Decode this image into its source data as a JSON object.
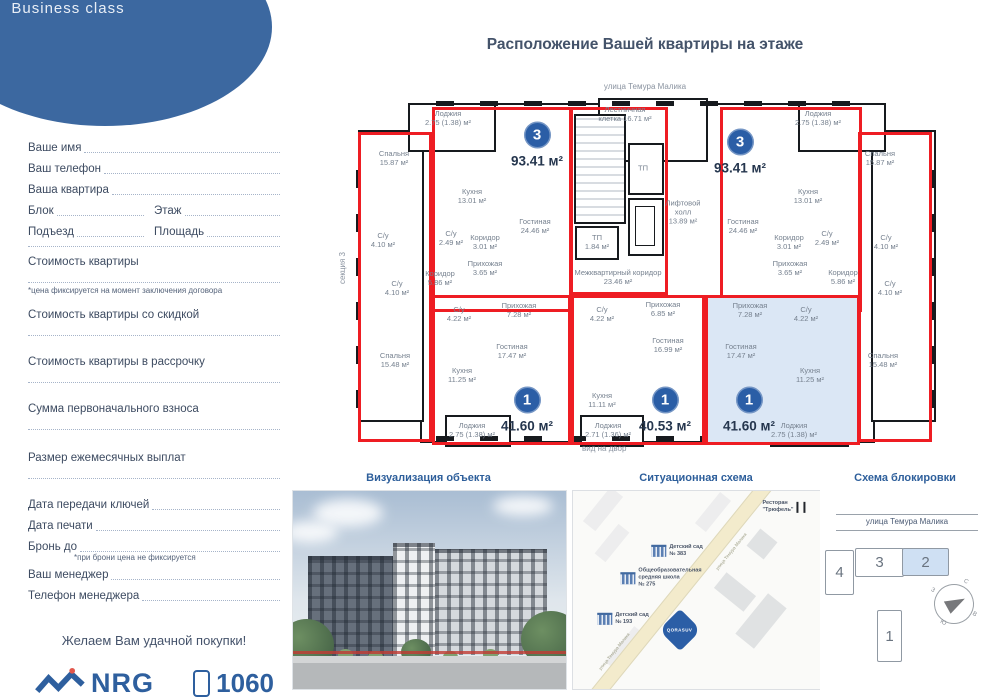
{
  "logo": {
    "brand": "QORASUV",
    "subtitle": "Business class"
  },
  "form": {
    "name_label": "Ваше имя",
    "phone_label": "Ваш телефон",
    "apartment_label": "Ваша квартира",
    "block_label": "Блок",
    "floor_label": "Этаж",
    "entrance_label": "Подъезд",
    "area_label": "Площадь",
    "price_label": "Стоимость квартиры",
    "price_note": "*цена фиксируется на момент заключения договора",
    "discount_price_label": "Стоимость квартиры со скидкой",
    "installment_price_label": "Стоимость квартиры в рассрочку",
    "down_payment_label": "Сумма первоначального взноса",
    "monthly_payment_label": "Размер ежемесячных выплат",
    "keys_date_label": "Дата передачи ключей",
    "print_date_label": "Дата печати",
    "reserve_until_label": "Бронь до",
    "reserve_note": "*при брони цена не фиксируется",
    "manager_label": "Ваш менеджер",
    "manager_phone_label": "Телефон менеджера",
    "wish": "Желаем Вам удачной покупки!"
  },
  "footer": {
    "brand": "NRG",
    "phone": "1060"
  },
  "floorplan": {
    "title": "Расположение Вашей квартиры на этаже",
    "street_top": "улица Темура Малика",
    "yard_label": "вид на двор",
    "section_label": "секция 3",
    "badges": [
      {
        "num": "3",
        "area": "93.41 м²",
        "x": 185,
        "y": 40
      },
      {
        "num": "3",
        "area": "93.41 м²",
        "x": 388,
        "y": 47
      },
      {
        "num": "1",
        "area": "41.60 м²",
        "x": 175,
        "y": 305
      },
      {
        "num": "1",
        "area": "40.53 м²",
        "x": 313,
        "y": 305
      },
      {
        "num": "1",
        "area": "41.60 м²",
        "x": 397,
        "y": 305
      }
    ],
    "rooms": [
      {
        "t": "Лоджия\n2.75 (1.38) м²",
        "x": 96,
        "y": 26
      },
      {
        "t": "Спальня\n15.87 м²",
        "x": 42,
        "y": 66
      },
      {
        "t": "Кухня\n13.01 м²",
        "x": 120,
        "y": 104
      },
      {
        "t": "Гостиная\n24.46 м²",
        "x": 183,
        "y": 134
      },
      {
        "t": "С/у\n2.49 м²",
        "x": 99,
        "y": 146
      },
      {
        "t": "Коридор\n3.01 м²",
        "x": 133,
        "y": 150
      },
      {
        "t": "Прихожая\n3.65 м²",
        "x": 133,
        "y": 176
      },
      {
        "t": "С/у\n4.10 м²",
        "x": 31,
        "y": 148
      },
      {
        "t": "С/у\n4.10 м²",
        "x": 45,
        "y": 196
      },
      {
        "t": "Коридор\n5.86 м²",
        "x": 88,
        "y": 186
      },
      {
        "t": "Спальня\n15.48 м²",
        "x": 43,
        "y": 268
      },
      {
        "t": "Лестничная\nклетка 16.71 м²",
        "x": 273,
        "y": 22
      },
      {
        "t": "ТП",
        "x": 291,
        "y": 76
      },
      {
        "t": "Лифтовой\nхолл\n13.89 м²",
        "x": 331,
        "y": 120
      },
      {
        "t": "ТП\n1.84 м²",
        "x": 245,
        "y": 150
      },
      {
        "t": "Межквартирный коридор\n23.46 м²",
        "x": 266,
        "y": 185
      },
      {
        "t": "Лоджия\n2.75 (1.38) м²",
        "x": 466,
        "y": 26
      },
      {
        "t": "Спальня\n15.87 м²",
        "x": 528,
        "y": 66
      },
      {
        "t": "Кухня\n13.01 м²",
        "x": 456,
        "y": 104
      },
      {
        "t": "Гостиная\n24.46 м²",
        "x": 391,
        "y": 134
      },
      {
        "t": "С/у\n2.49 м²",
        "x": 475,
        "y": 146
      },
      {
        "t": "Коридор\n3.01 м²",
        "x": 437,
        "y": 150
      },
      {
        "t": "Прихожая\n3.65 м²",
        "x": 438,
        "y": 176
      },
      {
        "t": "С/у\n4.10 м²",
        "x": 534,
        "y": 150
      },
      {
        "t": "С/у\n4.10 м²",
        "x": 538,
        "y": 196
      },
      {
        "t": "Коридор\n5.86 м²",
        "x": 491,
        "y": 185
      },
      {
        "t": "Спальня\n15.48 м²",
        "x": 531,
        "y": 268
      },
      {
        "t": "С/у\n4.22 м²",
        "x": 107,
        "y": 222
      },
      {
        "t": "Прихожая\n7.28 м²",
        "x": 167,
        "y": 218
      },
      {
        "t": "Гостиная\n17.47 м²",
        "x": 160,
        "y": 259
      },
      {
        "t": "Кухня\n11.25 м²",
        "x": 110,
        "y": 283
      },
      {
        "t": "Лоджия\n2.75 (1.38) м²",
        "x": 120,
        "y": 338
      },
      {
        "t": "С/у\n4.22 м²",
        "x": 250,
        "y": 222
      },
      {
        "t": "Прихожая\n6.85 м²",
        "x": 311,
        "y": 217
      },
      {
        "t": "Гостиная\n16.99 м²",
        "x": 316,
        "y": 253
      },
      {
        "t": "Кухня\n11.11 м²",
        "x": 250,
        "y": 308
      },
      {
        "t": "Лоджия\n2.71 (1.36) м²",
        "x": 256,
        "y": 338
      },
      {
        "t": "Прихожая\n7.28 м²",
        "x": 398,
        "y": 218
      },
      {
        "t": "С/у\n4.22 м²",
        "x": 454,
        "y": 222
      },
      {
        "t": "Гостиная\n17.47 м²",
        "x": 389,
        "y": 259
      },
      {
        "t": "Кухня\n11.25 м²",
        "x": 458,
        "y": 283
      },
      {
        "t": "Лоджия\n2.75 (1.38) м²",
        "x": 442,
        "y": 338
      }
    ]
  },
  "viz": {
    "title": "Визуализация объекта"
  },
  "map": {
    "title": "Ситуационная схема",
    "road_label": "улица Темура Малика",
    "pois": [
      {
        "type": "restaurant",
        "label": "Ресторан\n\"Трюфель\"",
        "x": 211,
        "y": 16
      },
      {
        "type": "building",
        "label": "Детский сад\n№ 383",
        "x": 104,
        "y": 60
      },
      {
        "type": "building",
        "label": "Общеобразовательная\nсредняя школа\n№ 275",
        "x": 88,
        "y": 87
      },
      {
        "type": "building",
        "label": "Детский сад\n№ 193",
        "x": 50,
        "y": 128
      },
      {
        "type": "marker",
        "label": "QORASUV",
        "x": 107,
        "y": 139
      }
    ]
  },
  "blocking": {
    "title": "Схема блокировки",
    "street_label": "улица Темура Малика",
    "blocks": [
      {
        "label": "4",
        "x": 5,
        "y": 60,
        "w": 27,
        "h": 43,
        "hl": false
      },
      {
        "label": "3",
        "x": 35,
        "y": 58,
        "w": 47,
        "h": 27,
        "hl": false
      },
      {
        "label": "2",
        "x": 82,
        "y": 58,
        "w": 45,
        "h": 26,
        "hl": true
      },
      {
        "label": "1",
        "x": 57,
        "y": 120,
        "w": 23,
        "h": 50,
        "hl": false
      }
    ],
    "compass": {
      "n": "С",
      "e": "В",
      "s": "Ю",
      "w": "З"
    }
  }
}
